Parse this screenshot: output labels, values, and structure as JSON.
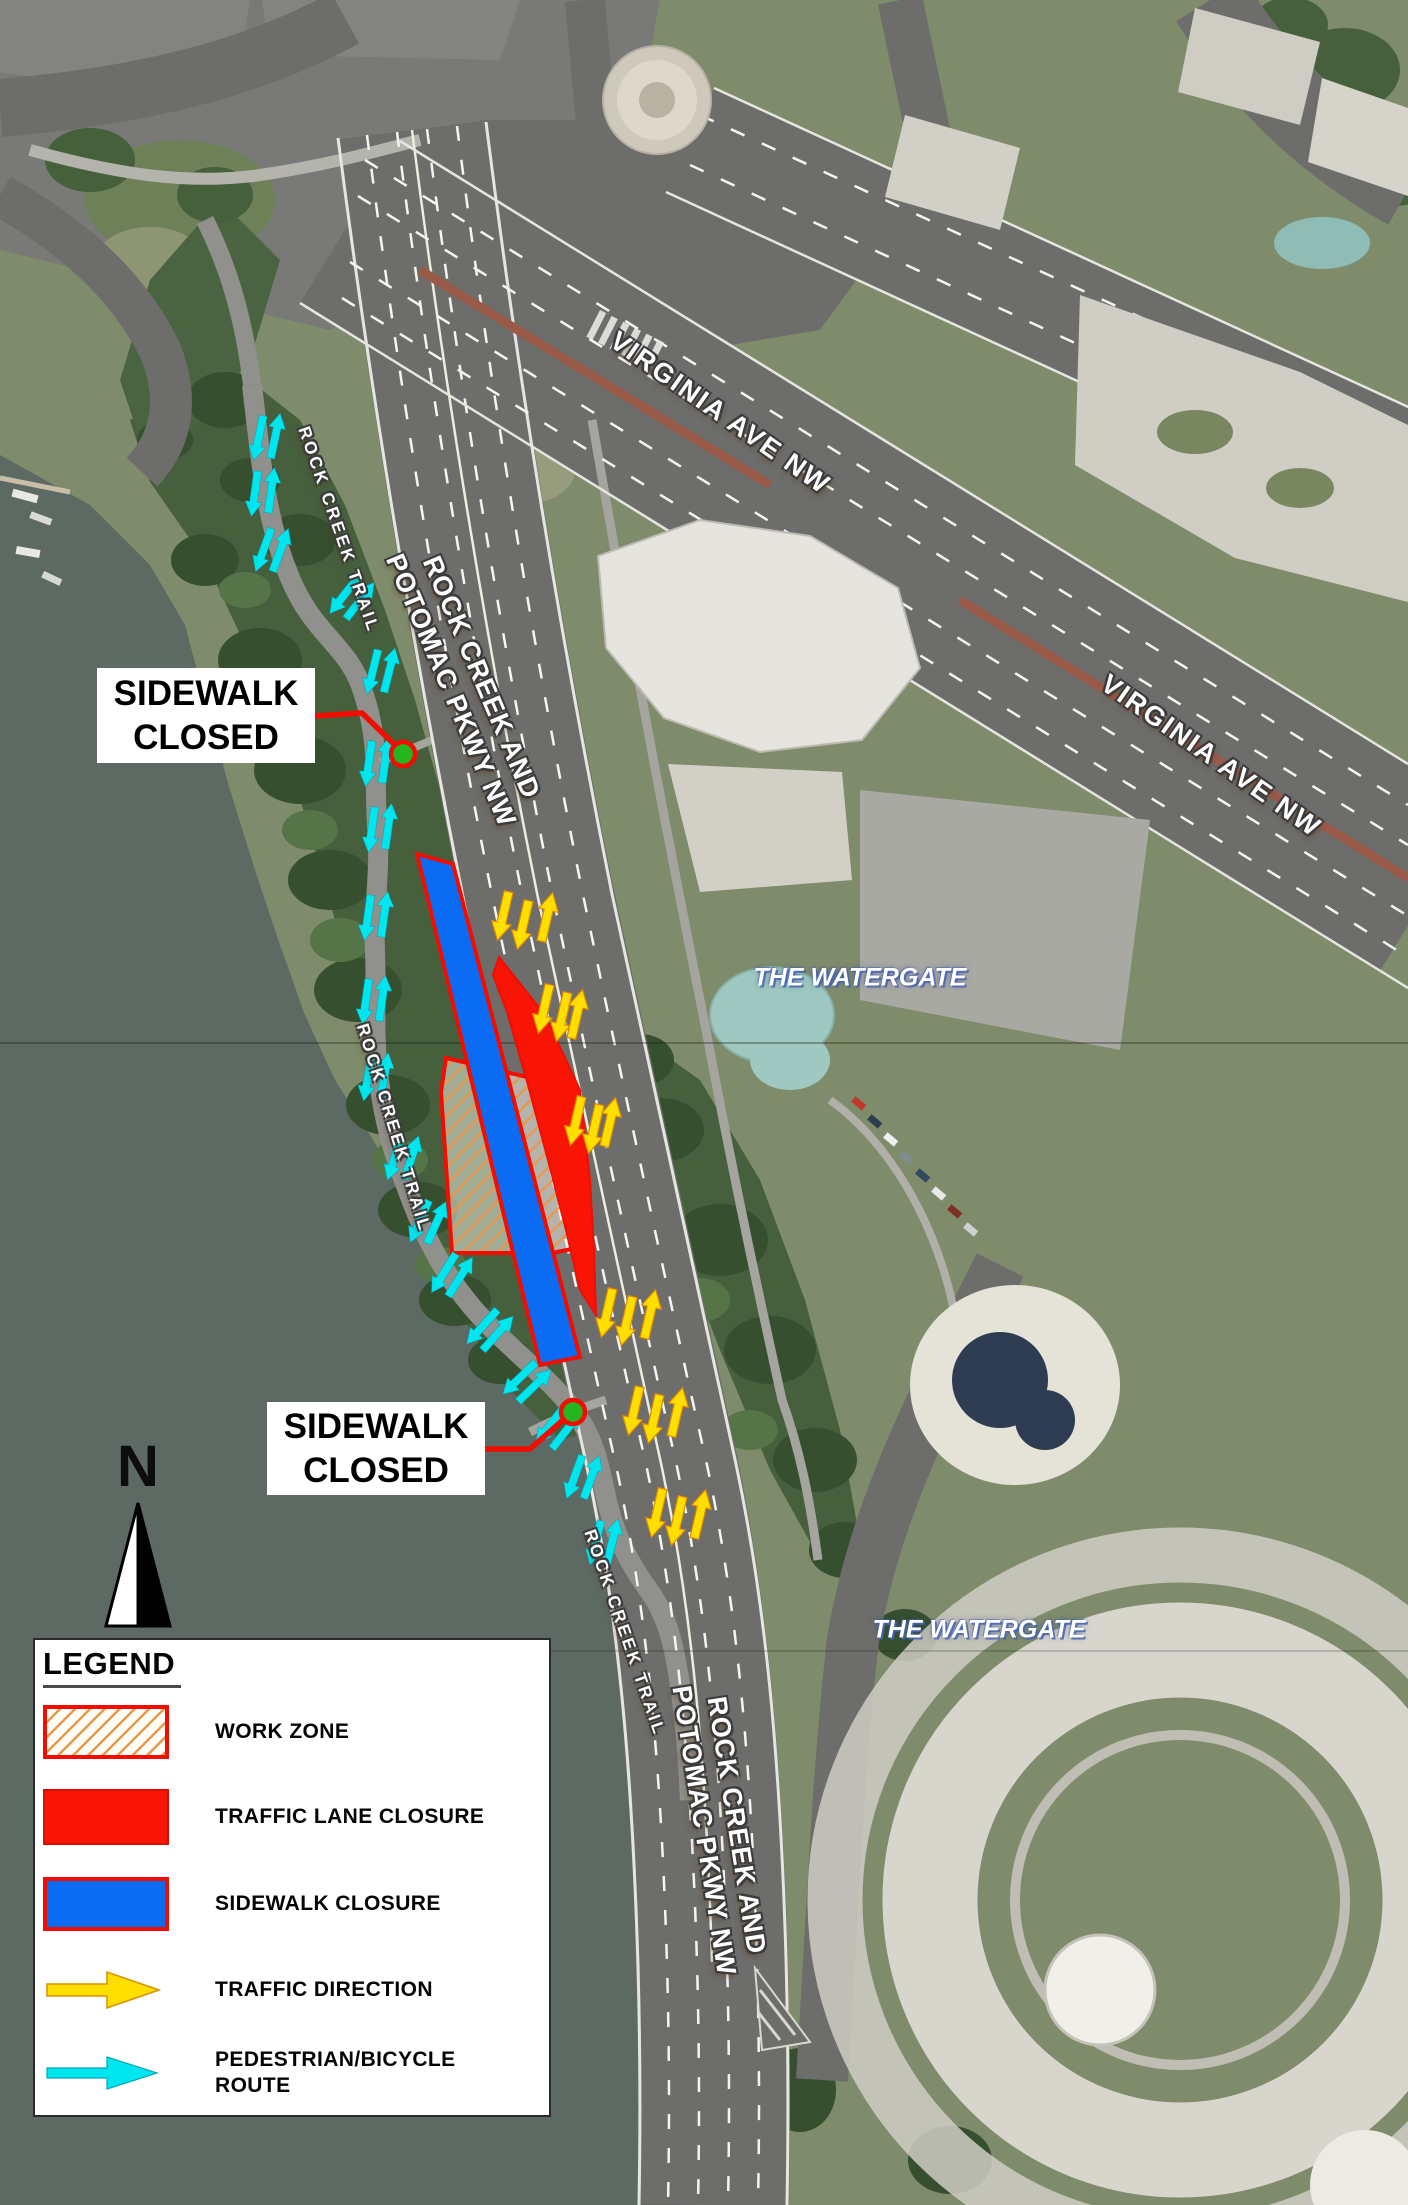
{
  "colors": {
    "closure_red": "#f20d00",
    "lane_closure_fill": "#f81505",
    "sidewalk_closure_blue": "#0b6bf2",
    "work_zone_hatch": "#e8984a",
    "traffic_arrow_yellow": "#ffdf00",
    "ped_route_cyan": "#00e6ef",
    "leader_dot_green": "#25b520"
  },
  "legend": {
    "title": "LEGEND",
    "items": [
      {
        "id": "work-zone",
        "label": "WORK ZONE",
        "swatch": "hatched-rect"
      },
      {
        "id": "traffic-lane-closure",
        "label": "TRAFFIC LANE CLOSURE",
        "swatch": "red-rect"
      },
      {
        "id": "sidewalk-closure",
        "label": "SIDEWALK CLOSURE",
        "swatch": "blue-rect"
      },
      {
        "id": "traffic-direction",
        "label": "TRAFFIC DIRECTION",
        "swatch": "yellow-arrow"
      },
      {
        "id": "pedestrian-bicycle-route",
        "label": "PEDESTRIAN/BICYCLE\nROUTE",
        "swatch": "cyan-arrow"
      }
    ]
  },
  "north_arrow": {
    "label": "N"
  },
  "callouts": [
    {
      "id": "sidewalk-closed-north",
      "text": "SIDEWALK\nCLOSED",
      "box": {
        "x": 97,
        "y": 668,
        "w": 218,
        "h": 95
      },
      "leader": "315,716 362,713 402,752",
      "dot": {
        "x": 403,
        "y": 754
      }
    },
    {
      "id": "sidewalk-closed-south",
      "text": "SIDEWALK\nCLOSED",
      "box": {
        "x": 267,
        "y": 1402,
        "w": 218,
        "h": 93
      },
      "leader": "485,1449 530,1449 571,1413",
      "dot": {
        "x": 573,
        "y": 1412
      }
    }
  ],
  "road_labels": [
    {
      "id": "virginia-ave-nw-upper",
      "text": "VIRGINIA AVE NW",
      "x": 720,
      "y": 413,
      "rot": 35,
      "size": 27,
      "spacing": 2
    },
    {
      "id": "virginia-ave-nw-lower",
      "text": "VIRGINIA AVE NW",
      "x": 1211,
      "y": 756,
      "rot": 35,
      "size": 27,
      "spacing": 2
    },
    {
      "id": "rock-creek-pkwy-upper",
      "text": "ROCK CREEK AND\nPOTOMAC PKWY NW",
      "x": 466,
      "y": 684,
      "rot": 67,
      "size": 27,
      "spacing": 1
    },
    {
      "id": "rock-creek-pkwy-lower",
      "text": "ROCK CREEK AND\nPOTOMAC PKWY NW",
      "x": 720,
      "y": 1828,
      "rot": 81,
      "size": 27,
      "spacing": 1
    },
    {
      "id": "rock-creek-trail-upper",
      "text": "ROCK CREEK TRAIL",
      "x": 338,
      "y": 530,
      "rot": 71,
      "size": 17,
      "spacing": 3
    },
    {
      "id": "rock-creek-trail-middle",
      "text": "ROCK CREEK TRAIL",
      "x": 393,
      "y": 1128,
      "rot": 73,
      "size": 17,
      "spacing": 3
    },
    {
      "id": "rock-creek-trail-lower",
      "text": "ROCK CREEK TRAIL",
      "x": 624,
      "y": 1633,
      "rot": 71,
      "size": 17,
      "spacing": 3
    }
  ],
  "place_labels": [
    {
      "id": "the-watergate-north",
      "text": "THE WATERGATE",
      "x": 860,
      "y": 978,
      "size": 25
    },
    {
      "id": "the-watergate-south",
      "text": "THE WATERGATE",
      "x": 979,
      "y": 1630,
      "size": 25
    }
  ],
  "overlays": {
    "work_zone_polygon": "446,1058 540,1080 560,1140 577,1232 577,1248 552,1253 452,1253 441,1092",
    "lane_closure_polygon": "499,957 545,1015 580,1090 590,1180 594,1250 596,1315 580,1290 566,1230 548,1160 528,1085 507,1012 493,975",
    "sidewalk_closure_polygon": "417,854 453,864 580,1357 540,1365",
    "traffic_arrows": [
      {
        "x": 503,
        "y": 916,
        "r": 193
      },
      {
        "x": 523,
        "y": 925,
        "r": 193
      },
      {
        "x": 547,
        "y": 917,
        "r": 13
      },
      {
        "x": 544,
        "y": 1009,
        "r": 193
      },
      {
        "x": 562,
        "y": 1017,
        "r": 193
      },
      {
        "x": 577,
        "y": 1014,
        "r": 13
      },
      {
        "x": 576,
        "y": 1121,
        "r": 193
      },
      {
        "x": 594,
        "y": 1129,
        "r": 193
      },
      {
        "x": 610,
        "y": 1122,
        "r": 13
      },
      {
        "x": 607,
        "y": 1313,
        "r": 193
      },
      {
        "x": 627,
        "y": 1321,
        "r": 193
      },
      {
        "x": 650,
        "y": 1314,
        "r": 13
      },
      {
        "x": 634,
        "y": 1411,
        "r": 193
      },
      {
        "x": 654,
        "y": 1419,
        "r": 193
      },
      {
        "x": 677,
        "y": 1412,
        "r": 13
      },
      {
        "x": 657,
        "y": 1513,
        "r": 193
      },
      {
        "x": 677,
        "y": 1521,
        "r": 193
      },
      {
        "x": 700,
        "y": 1514,
        "r": 13
      }
    ],
    "ped_arrow_pairs": [
      {
        "x": 267,
        "y": 437,
        "r": 12
      },
      {
        "x": 263,
        "y": 492,
        "r": 8
      },
      {
        "x": 272,
        "y": 550,
        "r": 20
      },
      {
        "x": 352,
        "y": 598,
        "r": 38
      },
      {
        "x": 381,
        "y": 671,
        "r": 14
      },
      {
        "x": 377,
        "y": 762,
        "r": 8
      },
      {
        "x": 380,
        "y": 828,
        "r": 8
      },
      {
        "x": 376,
        "y": 916,
        "r": 8
      },
      {
        "x": 374,
        "y": 1000,
        "r": 8
      },
      {
        "x": 376,
        "y": 1077,
        "r": 10
      },
      {
        "x": 403,
        "y": 1158,
        "r": 18
      },
      {
        "x": 428,
        "y": 1222,
        "r": 24
      },
      {
        "x": 452,
        "y": 1275,
        "r": 32
      },
      {
        "x": 490,
        "y": 1330,
        "r": 42
      },
      {
        "x": 527,
        "y": 1382,
        "r": 46
      },
      {
        "x": 558,
        "y": 1428,
        "r": 38
      },
      {
        "x": 583,
        "y": 1477,
        "r": 20
      },
      {
        "x": 604,
        "y": 1542,
        "r": 14
      }
    ]
  }
}
